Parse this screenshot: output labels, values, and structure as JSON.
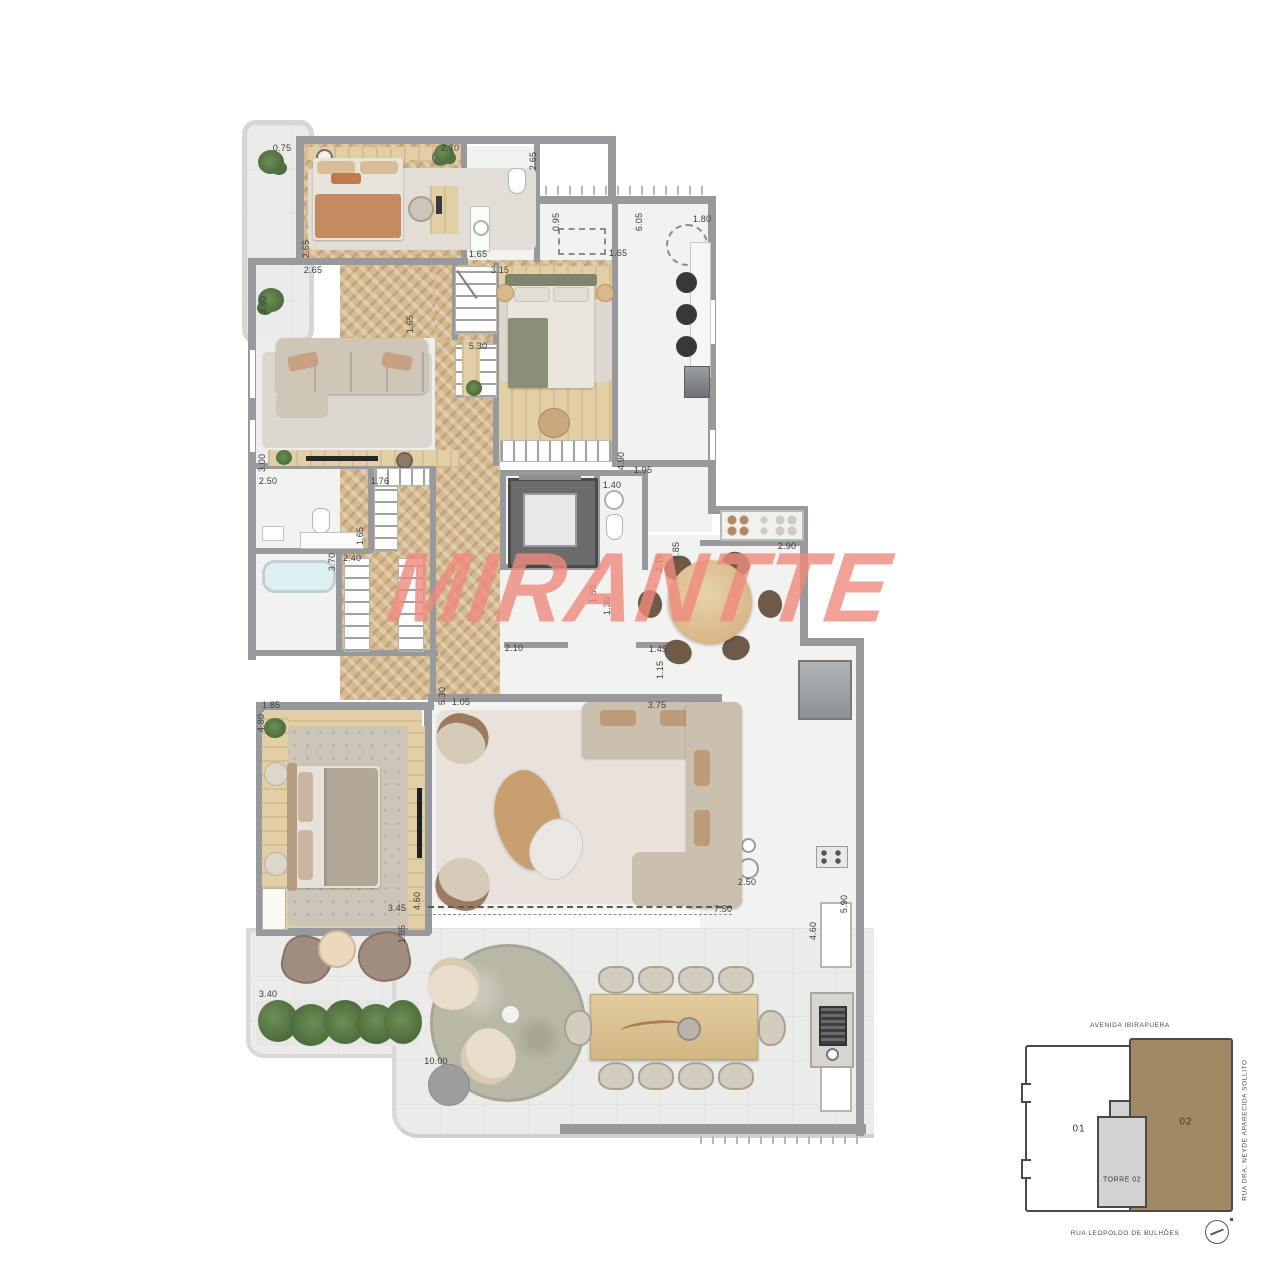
{
  "watermark": {
    "text": "MIRANTTE",
    "color": "#ef8a7e"
  },
  "colors": {
    "wall": "#98999c",
    "wood_floor": "#d6ba8e",
    "keyplan_highlight": "#a18a63",
    "terrace_green": "#4c6e3e"
  },
  "plan": {
    "dimensions": [
      {
        "label": "0.75",
        "x": 282,
        "y": 148,
        "rot": 0
      },
      {
        "label": "2.70",
        "x": 450,
        "y": 148,
        "rot": 0
      },
      {
        "label": "2.65",
        "x": 533,
        "y": 161,
        "rot": 1
      },
      {
        "label": "2.65",
        "x": 306,
        "y": 249,
        "rot": 1
      },
      {
        "label": "2.65",
        "x": 313,
        "y": 270,
        "rot": 0
      },
      {
        "label": "3.90",
        "x": 263,
        "y": 305,
        "rot": 1
      },
      {
        "label": "1.65",
        "x": 478,
        "y": 254,
        "rot": 0
      },
      {
        "label": "1.65",
        "x": 410,
        "y": 324,
        "rot": 1
      },
      {
        "label": "3.15",
        "x": 500,
        "y": 270,
        "rot": 0
      },
      {
        "label": "5.30",
        "x": 478,
        "y": 346,
        "rot": 0
      },
      {
        "label": "0.95",
        "x": 556,
        "y": 222,
        "rot": 1
      },
      {
        "label": "1.65",
        "x": 618,
        "y": 253,
        "rot": 0
      },
      {
        "label": "6.05",
        "x": 639,
        "y": 222,
        "rot": 1
      },
      {
        "label": "1.80",
        "x": 702,
        "y": 219,
        "rot": 0
      },
      {
        "label": "3.00",
        "x": 262,
        "y": 463,
        "rot": 1
      },
      {
        "label": "2.50",
        "x": 268,
        "y": 481,
        "rot": 0
      },
      {
        "label": "1.76",
        "x": 380,
        "y": 481,
        "rot": 0
      },
      {
        "label": "1.65",
        "x": 360,
        "y": 536,
        "rot": 1
      },
      {
        "label": "2.40",
        "x": 352,
        "y": 558,
        "rot": 0
      },
      {
        "label": "3.70",
        "x": 332,
        "y": 562,
        "rot": 1
      },
      {
        "label": "4.90",
        "x": 621,
        "y": 461,
        "rot": 1
      },
      {
        "label": "1.95",
        "x": 643,
        "y": 470,
        "rot": 0
      },
      {
        "label": "1.40",
        "x": 612,
        "y": 485,
        "rot": 0
      },
      {
        "label": "2.15",
        "x": 659,
        "y": 563,
        "rot": 1
      },
      {
        "label": "3.85",
        "x": 676,
        "y": 551,
        "rot": 1
      },
      {
        "label": "2.90",
        "x": 787,
        "y": 546,
        "rot": 0
      },
      {
        "label": "1.60",
        "x": 593,
        "y": 594,
        "rot": 1
      },
      {
        "label": "1.30",
        "x": 607,
        "y": 606,
        "rot": 1
      },
      {
        "label": "2.10",
        "x": 514,
        "y": 648,
        "rot": 0
      },
      {
        "label": "1.45",
        "x": 658,
        "y": 649,
        "rot": 0
      },
      {
        "label": "1.15",
        "x": 660,
        "y": 670,
        "rot": 1
      },
      {
        "label": "1.85",
        "x": 271,
        "y": 705,
        "rot": 0
      },
      {
        "label": "4.80",
        "x": 261,
        "y": 723,
        "rot": 1
      },
      {
        "label": "5.30",
        "x": 442,
        "y": 696,
        "rot": 1
      },
      {
        "label": "1.05",
        "x": 461,
        "y": 702,
        "rot": 0
      },
      {
        "label": "3.75",
        "x": 657,
        "y": 705,
        "rot": 0
      },
      {
        "label": "2.50",
        "x": 747,
        "y": 882,
        "rot": 0
      },
      {
        "label": "7.50",
        "x": 723,
        "y": 909,
        "rot": 0
      },
      {
        "label": "3.45",
        "x": 397,
        "y": 908,
        "rot": 0
      },
      {
        "label": "4.60",
        "x": 417,
        "y": 901,
        "rot": 1
      },
      {
        "label": "1.85",
        "x": 402,
        "y": 934,
        "rot": 1
      },
      {
        "label": "5.90",
        "x": 844,
        "y": 904,
        "rot": 1
      },
      {
        "label": "4.60",
        "x": 813,
        "y": 931,
        "rot": 1
      },
      {
        "label": "3.40",
        "x": 268,
        "y": 994,
        "rot": 0
      },
      {
        "label": "10.00",
        "x": 436,
        "y": 1061,
        "rot": 0
      }
    ]
  },
  "keyplan": {
    "street_top": "AVENIDA IBIRAPUERA",
    "street_right": "RUA DRA. NEYDE APARECIDA SOLLITO",
    "street_bottom": "RUA LEOPOLDO DE BULHÕES",
    "unit_left_label": "01",
    "unit_right_label": "02",
    "tower_label": "TORRE 02"
  }
}
